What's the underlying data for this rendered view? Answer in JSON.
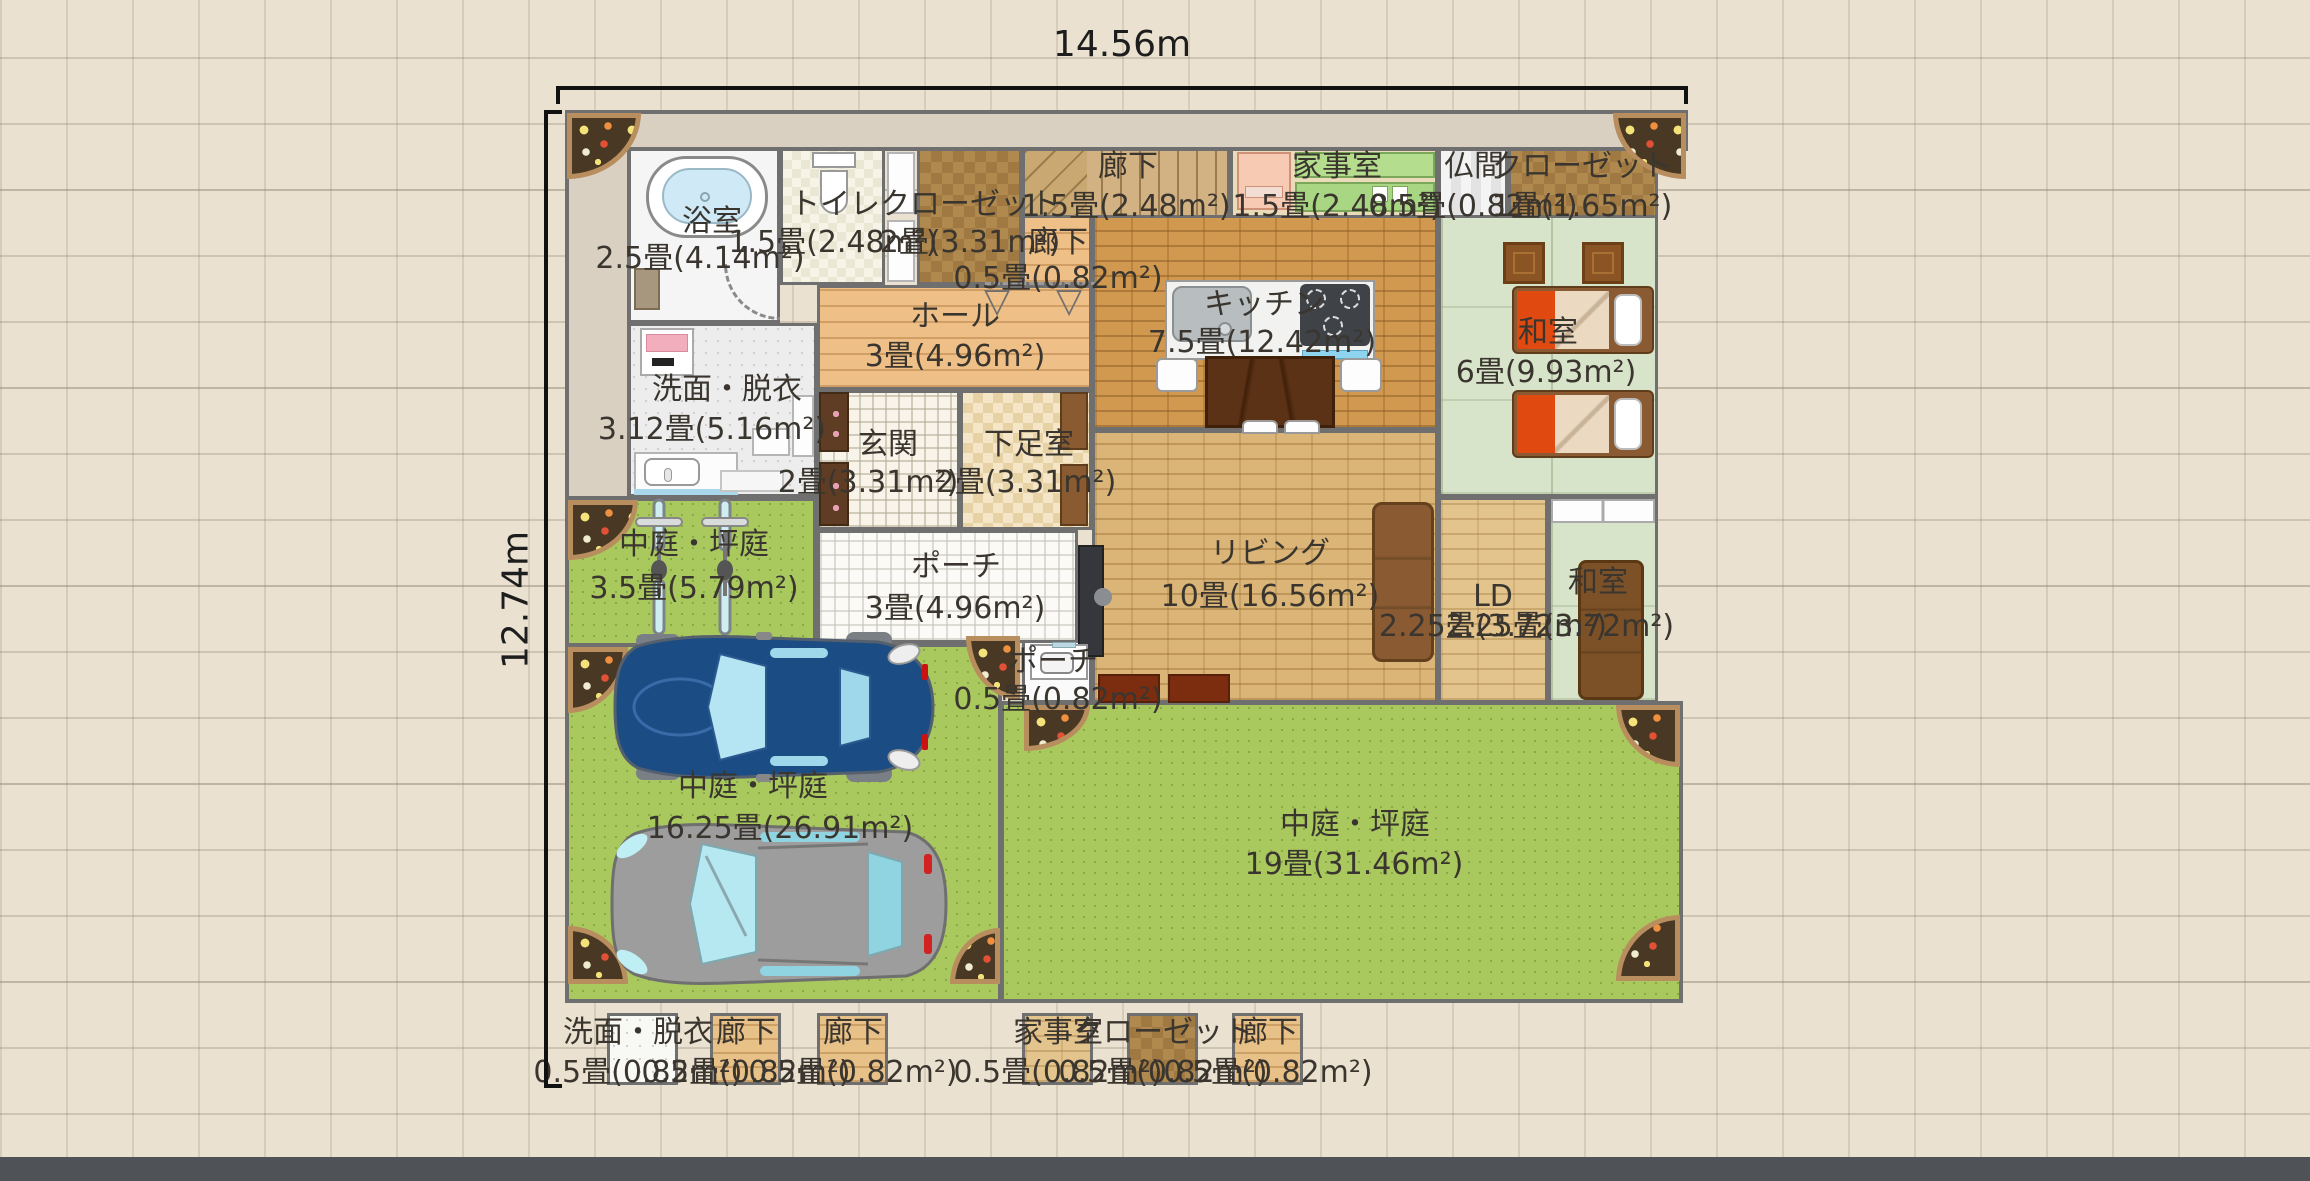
{
  "plan": {
    "width_label": "14.56m",
    "height_label": "12.74m"
  },
  "rooms": {
    "bath": {
      "name": "浴室",
      "area": "2.5畳(4.14m²)"
    },
    "toilet": {
      "name": "トイレ",
      "area": "1.5畳(2.48m²)"
    },
    "closet_upper": {
      "name": "クローゼット",
      "area": "2畳(3.31m²)"
    },
    "corridor_stairs": {
      "name": "廊下",
      "area": "1.5畳(2.48m²)"
    },
    "utility_room": {
      "name": "家事室",
      "area": "1.5畳(2.48m²)"
    },
    "butsuma": {
      "name": "仏間",
      "area": "0.5畳(0.82m²)"
    },
    "closet_right": {
      "name": "クローゼット",
      "area": "1畳(1.65m²)"
    },
    "corridor_small": {
      "name": "廊下",
      "area": "0.5畳(0.82m²)"
    },
    "kitchen": {
      "name": "キッチン",
      "area": "7.5畳(12.42m²)"
    },
    "washitsu_main": {
      "name": "和室",
      "area": "6畳(9.93m²)"
    },
    "hall": {
      "name": "ホール",
      "area": "3畳(4.96m²)"
    },
    "washroom": {
      "name": "洗面・脱衣",
      "area": "3.12畳(5.16m²)"
    },
    "entrance": {
      "name": "玄関",
      "area": "2畳(3.31m²)"
    },
    "shoe_room": {
      "name": "下足室",
      "area": "2畳(3.31m²)"
    },
    "living": {
      "name": "リビング",
      "area": "10畳(16.56m²)"
    },
    "ld": {
      "name": "LD",
      "area": "2.25畳(3.72m²)"
    },
    "washitsu_small": {
      "name": "和室",
      "area": "2.25畳(3.72m²)"
    },
    "porch": {
      "name": "ポーチ",
      "area": "3畳(4.96m²)"
    },
    "porch_small": {
      "name": "ポーチ",
      "area": "0.5畳(0.82m²)"
    },
    "garden_side": {
      "name": "中庭・坪庭",
      "area": "3.5畳(5.79m²)"
    },
    "garden_drive": {
      "name": "中庭・坪庭",
      "area": "16.25畳(26.91m²)"
    },
    "garden_main": {
      "name": "中庭・坪庭",
      "area": "19畳(31.46m²)"
    }
  },
  "legend_row": [
    {
      "name": "洗面・脱衣",
      "area": "0.5畳(0.82m²)"
    },
    {
      "name": "廊下",
      "area": "0.5畳(0.82m²)"
    },
    {
      "name": "廊下",
      "area": "0.5畳(0.82m²)"
    },
    {
      "name": "家事室",
      "area": "0.5畳(0.82m²)"
    },
    {
      "name": "クローゼット",
      "area": "0.5畳(0.82m²)"
    },
    {
      "name": "廊下",
      "area": "0.5畳(0.82m²)"
    }
  ],
  "colors": {
    "background": "#eae1d0",
    "grid_line": "#cfc5b3",
    "wall": "#6f6f6f",
    "garden": "#a9c95f",
    "tatami": "#d8e4ca",
    "kitchen_brick": "#d1994f",
    "living_brick": "#dab577",
    "flower_bed": "#493823",
    "car_blue": "#1c4c84",
    "car_gray": "#9d9d9d",
    "bottom_bar": "#4f5257"
  }
}
